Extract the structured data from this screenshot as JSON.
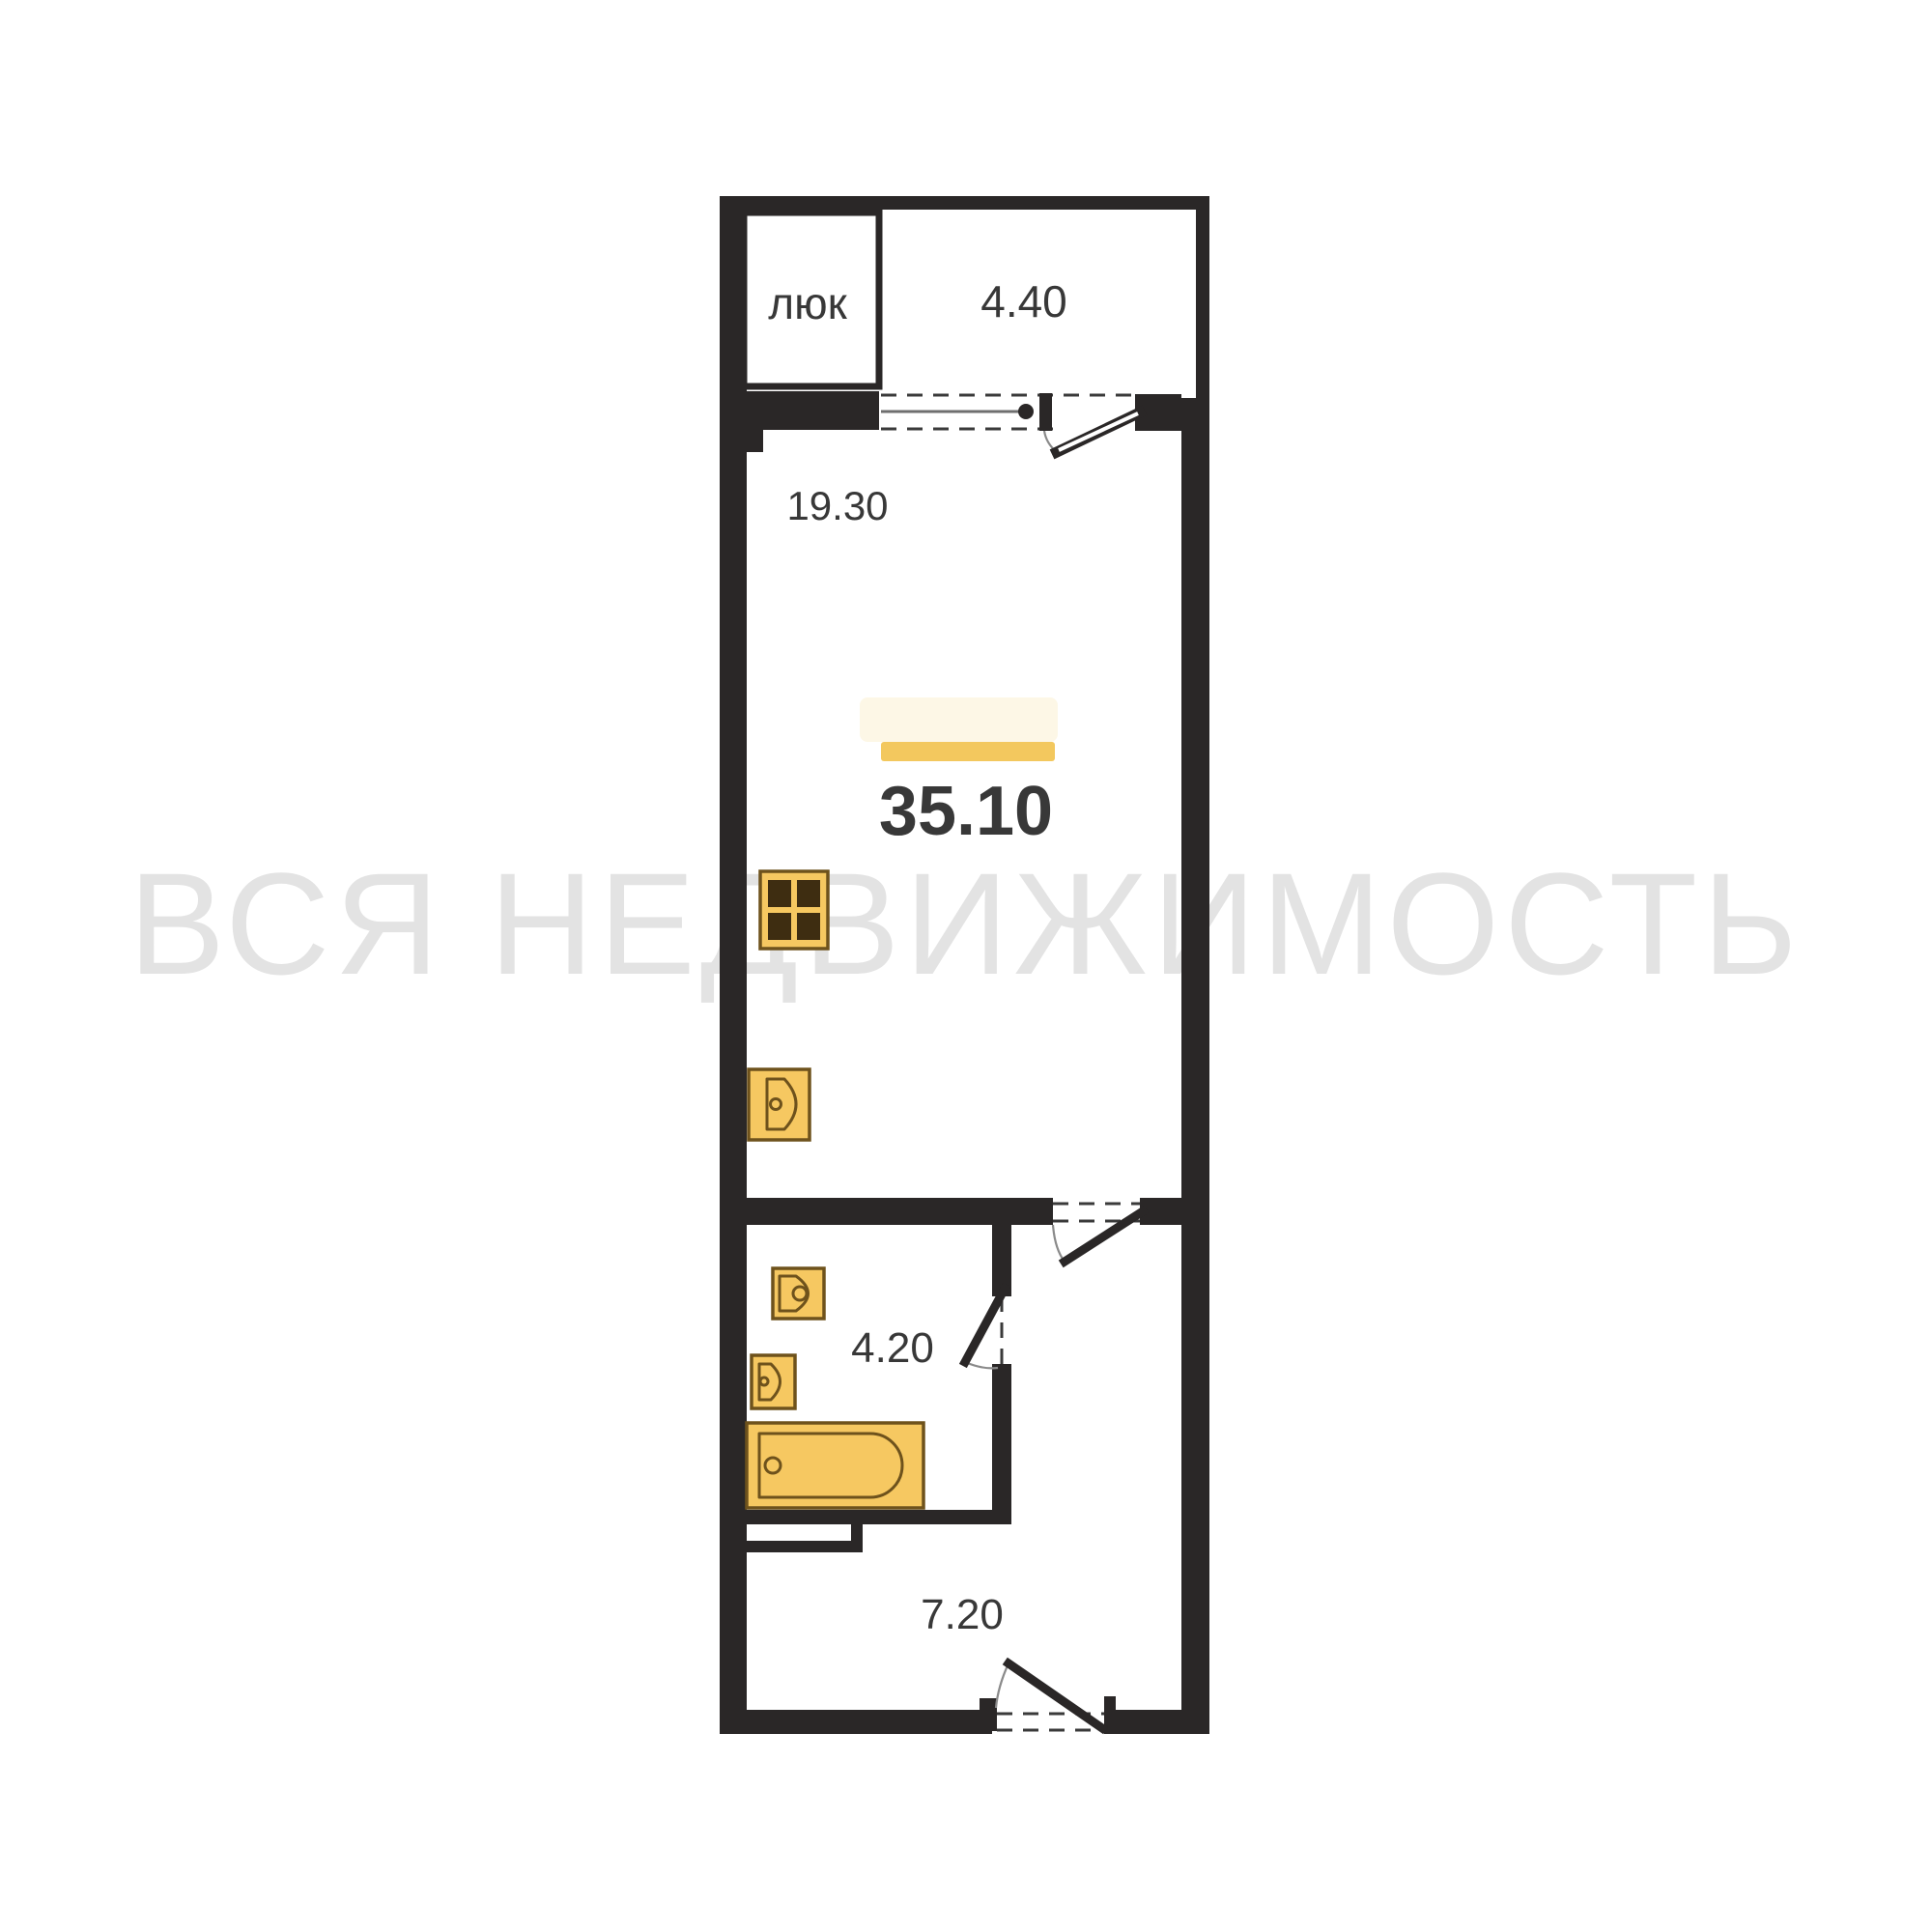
{
  "watermark": {
    "text": "ВСЯ НЕДВИЖИМОСТЬ"
  },
  "plan": {
    "hatch_label": "люк",
    "balcony_area": "4.40",
    "living_area": "19.30",
    "total_area": "35.10",
    "bathroom_area": "4.20",
    "hallway_area": "7.20"
  },
  "colors": {
    "wall": "#2A2727",
    "fixture_fill": "#F6C861",
    "fixture_stroke": "#6E521C",
    "burner": "#3E2D11",
    "accent_line": "#F3C85E",
    "accent_glow": "#FBF1D5",
    "watermark": "#E3E3E3",
    "label": "#383838",
    "dash": "#3A3A3A",
    "arc": "#8A8A8A",
    "window": "#6F6F6F"
  }
}
